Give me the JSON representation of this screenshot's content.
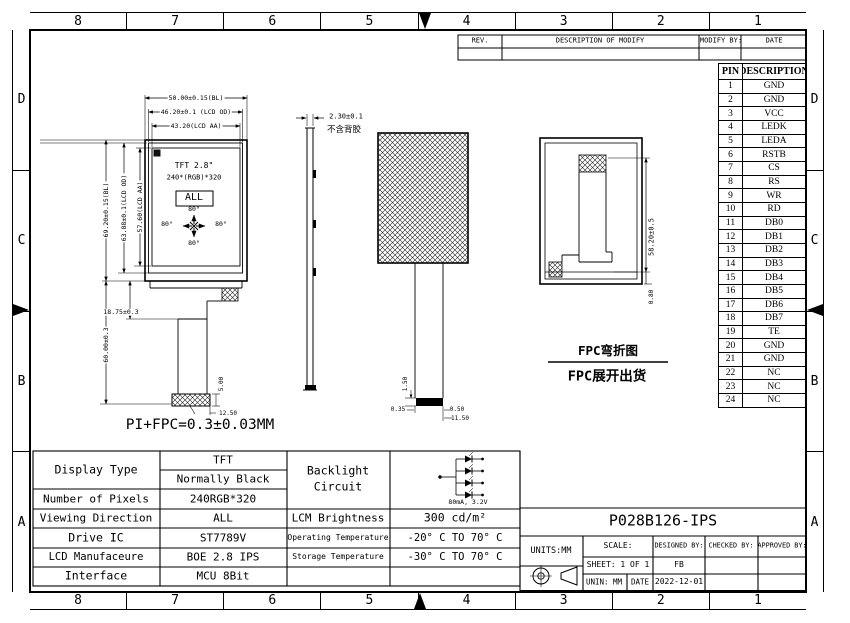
{
  "border": {
    "top_columns": [
      "8",
      "7",
      "6",
      "5",
      "4",
      "3",
      "2",
      "1"
    ],
    "bottom_columns": [
      "8",
      "7",
      "6",
      "5",
      "4",
      "3",
      "2",
      "1"
    ],
    "left_rows": [
      "D",
      "C",
      "B",
      "A"
    ],
    "right_rows": [
      "D",
      "C",
      "B",
      "A"
    ]
  },
  "rev_table": {
    "col_rev": "REV.",
    "col_desc": "DESCRIPTION OF MODIFY",
    "col_by": "MODIFY BY:",
    "col_date": "DATE"
  },
  "pin_table": {
    "header_pin": "PIN",
    "header_desc": "DESCRIPTION",
    "rows": [
      [
        "1",
        "GND"
      ],
      [
        "2",
        "GND"
      ],
      [
        "3",
        "VCC"
      ],
      [
        "4",
        "LEDK"
      ],
      [
        "5",
        "LEDA"
      ],
      [
        "6",
        "RSTB"
      ],
      [
        "7",
        "CS"
      ],
      [
        "8",
        "RS"
      ],
      [
        "9",
        "WR"
      ],
      [
        "10",
        "RD"
      ],
      [
        "11",
        "DB0"
      ],
      [
        "12",
        "DB1"
      ],
      [
        "13",
        "DB2"
      ],
      [
        "14",
        "DB3"
      ],
      [
        "15",
        "DB4"
      ],
      [
        "16",
        "DB5"
      ],
      [
        "17",
        "DB6"
      ],
      [
        "18",
        "DB7"
      ],
      [
        "19",
        "TE"
      ],
      [
        "20",
        "GND"
      ],
      [
        "21",
        "GND"
      ],
      [
        "22",
        "NC"
      ],
      [
        "23",
        "NC"
      ],
      [
        "24",
        "NC"
      ]
    ]
  },
  "front_view": {
    "dim_width_bl": "50.00±0.15(BL)",
    "dim_width_od": "46.20±0.1 (LCD OD)",
    "dim_width_aa": "43.20(LCD AA)",
    "dim_height_bl": "69.20±0.15(BL)",
    "dim_height_od": "63.88±0.1(LCD OD)",
    "dim_height_aa": "57.60(LCD AA)",
    "panel_line1": "TFT 2.8\"",
    "panel_line2": "240*(RGB)*320",
    "viewing_direction": "ALL",
    "angle_top": "80°",
    "angle_bottom": "80°",
    "angle_left": "80°",
    "angle_right": "80°",
    "dim_fpc_offset": "18.75±0.3",
    "dim_fpc_length": "60.00±0.3",
    "dim_connector_height": "5.00",
    "dim_connector_width": "12.50",
    "note_thickness": "PI+FPC=0.3±0.03MM"
  },
  "side_view": {
    "dim_thickness": "2.30±0.1",
    "note_adhesive": "不含背胶"
  },
  "middle_view": {
    "dim_stiffener": "1.50",
    "dim_left": "0.35",
    "dim_right": "0.50",
    "dim_tail_width": "11.50"
  },
  "back_view": {
    "dim_fpc_height": "58.20±0.5",
    "dim_bottom": "0.80",
    "caption_line1": "FPC弯折图",
    "caption_line2": "FPC展开出货"
  },
  "spec_table": {
    "rows": [
      {
        "label": "Display Type",
        "value1": "TFT",
        "value2": "Normally Black"
      },
      {
        "label": "Number of Pixels",
        "value": "240RGB*320"
      },
      {
        "label": "Viewing Direction",
        "value": "ALL"
      },
      {
        "label": "Drive IC",
        "value": "ST7789V"
      },
      {
        "label": "LCD Manufaceure",
        "value": "BOE 2.8 IPS"
      },
      {
        "label": "Interface",
        "value": "MCU 8Bit"
      }
    ]
  },
  "env_table": {
    "backlight_label_line1": "Backlight",
    "backlight_label_line2": "Circuit",
    "backlight_rating": "80mA, 3.2V",
    "brightness_label": "LCM Brightness",
    "brightness_value": "300 cd/m²",
    "operating_label": "Operating Temperature",
    "operating_value": "-20° C TO 70° C",
    "storage_label": "Storage Temperature",
    "storage_value": "-30° C TO 70° C"
  },
  "title_block": {
    "model": "P028B126-IPS",
    "units": "UNITS:MM",
    "scale_label": "SCALE:",
    "designed_label": "DESIGNED BY:",
    "checked_label": "CHECKED BY:",
    "approved_label": "APPROVED BY:",
    "sheet": "SHEET: 1 OF 1",
    "designed_value": "FB",
    "unit_label": "UNIN: MM",
    "date_label": "DATE",
    "date_value": "2022-12-01"
  }
}
